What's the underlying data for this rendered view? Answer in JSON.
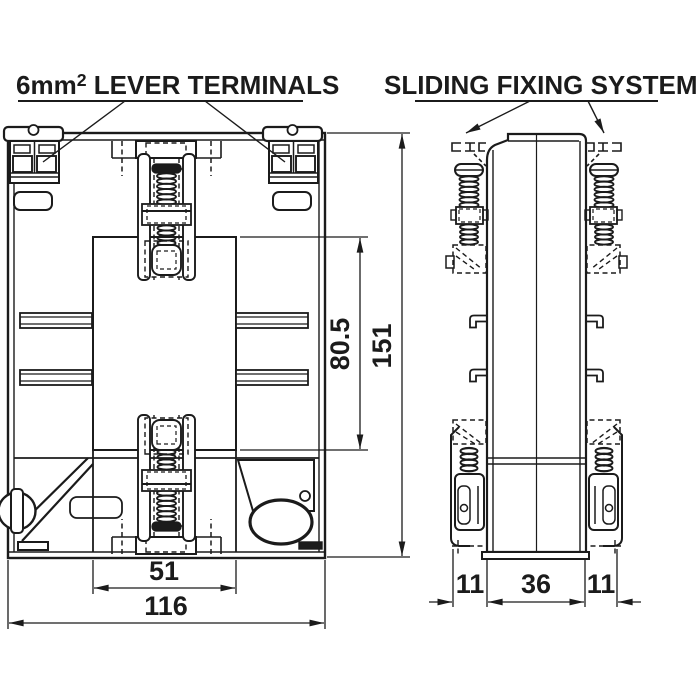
{
  "titles": {
    "lever_terminals": {
      "prefix": "6mm",
      "sup": "2",
      "suffix": " LEVER TERMINALS"
    },
    "sliding_fixing": "SLIDING FIXING SYSTEM"
  },
  "dimensions": {
    "front": {
      "overall_height": "151",
      "window_height": "80.5",
      "inner_width": "51",
      "overall_width": "116"
    },
    "side": {
      "left_offset": "11",
      "body_width": "36",
      "right_offset": "11"
    }
  },
  "colors": {
    "line": "#1b1b1b",
    "background": "#ffffff"
  }
}
